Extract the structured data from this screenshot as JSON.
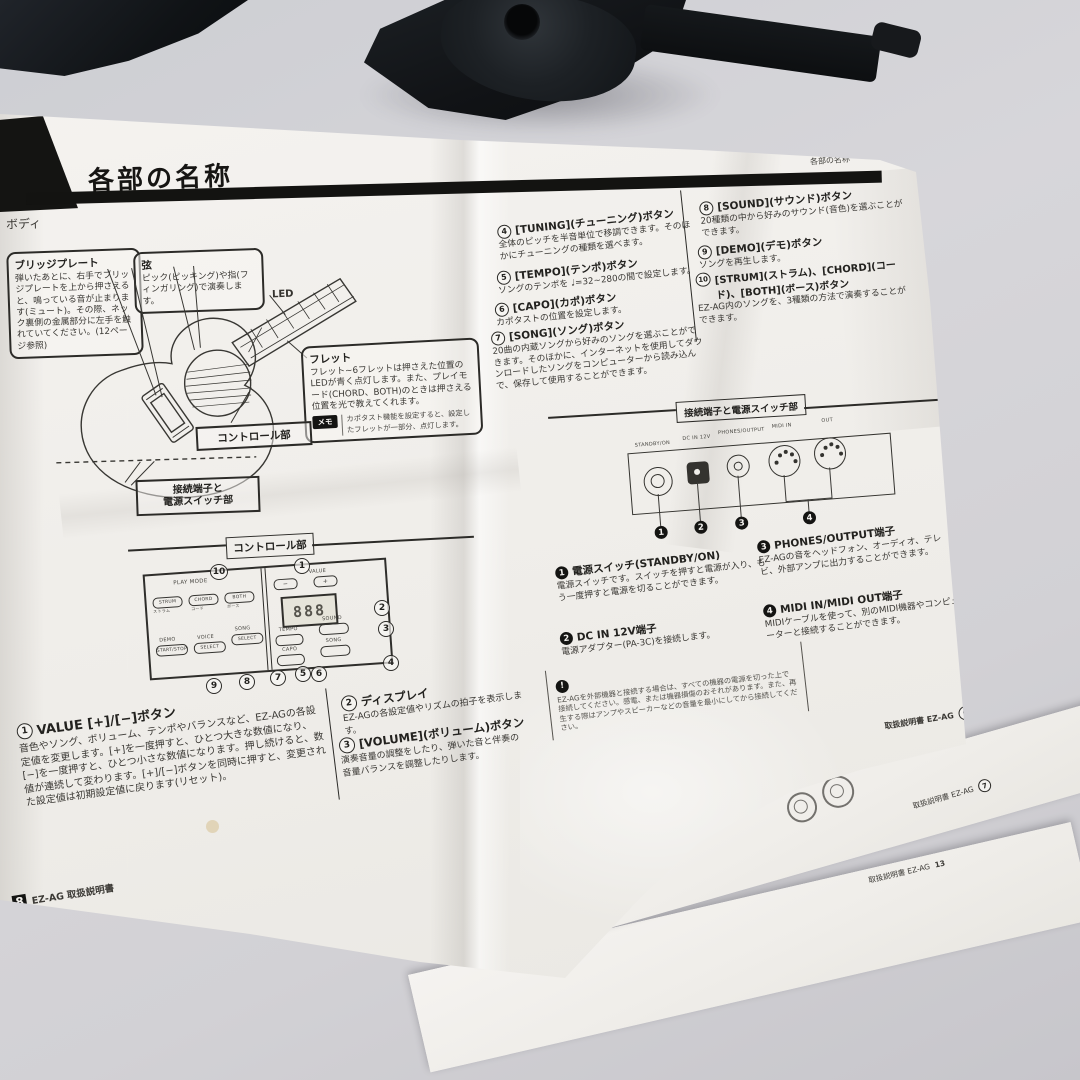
{
  "doc": {
    "chapter_title": "各部の名称",
    "corner_header": "各部の名称",
    "left": {
      "body_label": "ボディ",
      "bridge_callout": {
        "title": "ブリッジプレート",
        "text": "弾いたあとに、右手でブリッジプレートを上から押さえると、鳴っている音が止まります(ミュート)。その際、ネック裏側の金属部分に左手を触れていてください。(12ページ参照)"
      },
      "string_callout": {
        "title": "弦",
        "text": "ピック(ピッキング)や指(フィンガリング)で演奏します。"
      },
      "led_label": "LED",
      "fret_callout": {
        "title": "フレット",
        "text": "フレット~6フレットは押さえた位置のLEDが青く点灯します。また、プレイモード(CHORD、BOTH)のときは押さえる位置を光で教えてくれます。",
        "memo_tag": "メモ",
        "memo_text": "カポタスト機能を設定すると、設定したフレットが一部分、点灯します。"
      },
      "control_pointer": "コントロール部",
      "jack_pointer_line1": "接続端子と",
      "jack_pointer_line2": "電源スイッチ部",
      "control_section_heading": "コントロール部",
      "panel": {
        "play_mode": "PLAY MODE",
        "strum": "STRUM",
        "strum_jp": "ストラム",
        "chord": "CHORD",
        "chord_jp": "コード",
        "both": "BOTH",
        "both_jp": "ボース",
        "value": "VALUE",
        "minus": "−",
        "plus": "+",
        "display": "888",
        "tempo": "TEMPO",
        "sound": "SOUND",
        "capo": "CAPO",
        "song": "SONG",
        "demo": "DEMO",
        "demo_sub": "START/STOP",
        "voice": "VOICE",
        "voice_sub": "SELECT",
        "song_sel": "SONG",
        "song_sel_sub": "SELECT"
      },
      "panel_callouts": [
        "1",
        "2",
        "3",
        "4",
        "5",
        "6",
        "7",
        "8",
        "9",
        "10"
      ],
      "items": [
        {
          "num": "1",
          "title": "VALUE [+]/[−]ボタン",
          "text": "音色やソング、ボリューム、テンポやバランスなど、EZ-AGの各設定値を変更します。[+]を一度押すと、ひとつ大きな数値になり、[−]を一度押すと、ひとつ小さな数値になります。押し続けると、数値が連続して変わります。[+]/[−]ボタンを同時に押すと、変更された設定値は初期設定値に戻ります(リセット)。"
        },
        {
          "num": "2",
          "title": "ディスプレイ",
          "text": "EZ-AGの各設定値やリズムの拍子を表示します。"
        },
        {
          "num": "3",
          "title": "[VOLUME](ボリューム)ボタン",
          "text": "演奏音量の調整をしたり、弾いた音と伴奏の音量バランスを調整したりします。"
        }
      ],
      "footer_page": "8",
      "footer_label": "EZ-AG 取扱説明書"
    },
    "right": {
      "items": [
        {
          "num": "4",
          "title": "[TUNING](チューニング)ボタン",
          "text": "全体のピッチを半音単位で移調できます。そのほかにチューニングの種類を選べます。"
        },
        {
          "num": "5",
          "title": "[TEMPO](テンポ)ボタン",
          "text": "ソングのテンポを ♩=32~280の間で設定します。"
        },
        {
          "num": "6",
          "title": "[CAPO](カポ)ボタン",
          "text": "カポタストの位置を設定します。"
        },
        {
          "num": "7",
          "title": "[SONG](ソング)ボタン",
          "text": "20曲の内蔵ソングから好みのソングを選ぶことができます。そのほかに、インターネットを使用してダウンロードしたソングをコンピューターから読み込んで、保存して使用することができます。"
        },
        {
          "num": "8",
          "title": "[SOUND](サウンド)ボタン",
          "text": "20種類の中から好みのサウンド(音色)を選ぶことができます。"
        },
        {
          "num": "9",
          "title": "[DEMO](デモ)ボタン",
          "text": "ソングを再生します。"
        },
        {
          "num": "10",
          "title": "[STRUM](ストラム)、[CHORD](コード)、[BOTH](ボース)ボタン",
          "text": "EZ-AG内のソングを、3種類の方法で演奏することができます。"
        }
      ],
      "jack_section_heading": "接続端子と電源スイッチ部",
      "rear_labels": {
        "power": "STANDBY/ON",
        "dc": "DC IN 12V",
        "phones": "PHONES/OUTPUT",
        "midi_in": "MIDI IN",
        "midi_out": "OUT"
      },
      "jack_callouts": [
        "1",
        "2",
        "3",
        "4"
      ],
      "jacks": [
        {
          "num": "1",
          "title": "電源スイッチ(STANDBY/ON)",
          "text": "電源スイッチです。スイッチを押すと電源が入り、もう一度押すと電源を切ることができます。"
        },
        {
          "num": "2",
          "title": "DC IN 12V端子",
          "text": "電源アダプター(PA-3C)を接続します。"
        },
        {
          "num": "3",
          "title": "PHONES/OUTPUT端子",
          "text": "EZ-AGの音をヘッドフォン、オーディオ、テレビ、外部アンプに出力することができます。"
        },
        {
          "num": "4",
          "title": "MIDI IN/MIDI OUT端子",
          "text": "MIDIケーブルを使って、別のMIDI機器やコンピューターと接続することができます。"
        }
      ],
      "note_icon": "!",
      "note_text": "EZ-AGを外部機器と接続する場合は、すべての機器の電源を切った上で接続してください。感電、または機器損傷のおそれがあります。また、再生する際はアンプやスピーカーなどの音量を最小にしてから接続してください。",
      "footer_label": "取扱説明書 EZ-AG",
      "footer_page": "9"
    },
    "under": {
      "sheet2_footer_label": "取扱説明書 EZ-AG",
      "sheet2_footer_page": "7",
      "sheet3_footer_label": "取扱説明書 EZ-AG",
      "sheet3_footer_page": "13"
    }
  }
}
